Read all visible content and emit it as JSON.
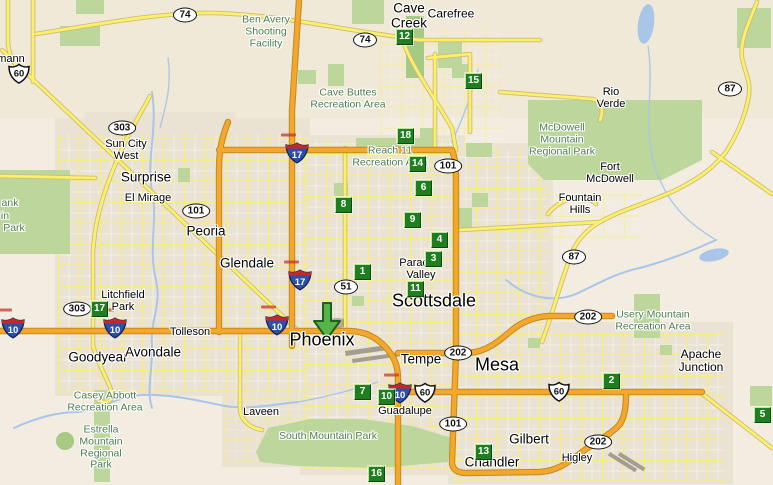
{
  "map": {
    "width": 773,
    "height": 485,
    "region": "Phoenix metropolitan area"
  },
  "palette": {
    "desert": "#F2EDE0",
    "urban": "#EAE3D4",
    "park": "#BCD69B",
    "park_dark": "#A6C983",
    "water": "#A9C5E8",
    "road_yellow": "#FBF169",
    "road_yellow_casing": "#CDBB7E",
    "road_orange": "#F5A72B",
    "road_orange_casing": "#BE8A25",
    "marker_green": "#1F7E1F",
    "marker_hi": "#BEE49E",
    "marker_lo": "#0B4A0B",
    "arrow_fill": "#57B44B",
    "arrow_stroke": "#1C611C",
    "park_label": "#4E7D50",
    "shield_blue": "#2B50A8",
    "shield_red": "#C62828"
  },
  "arrow": {
    "x": 327,
    "y": 320
  },
  "markers": [
    {
      "n": "1",
      "x": 362,
      "y": 271
    },
    {
      "n": "2",
      "x": 611,
      "y": 380
    },
    {
      "n": "3",
      "x": 433,
      "y": 258
    },
    {
      "n": "4",
      "x": 439,
      "y": 239
    },
    {
      "n": "5",
      "x": 762,
      "y": 414
    },
    {
      "n": "6",
      "x": 423,
      "y": 187
    },
    {
      "n": "7",
      "x": 362,
      "y": 391
    },
    {
      "n": "8",
      "x": 343,
      "y": 204
    },
    {
      "n": "9",
      "x": 412,
      "y": 219
    },
    {
      "n": "10",
      "x": 386,
      "y": 396
    },
    {
      "n": "11",
      "x": 415,
      "y": 288
    },
    {
      "n": "12",
      "x": 404,
      "y": 36
    },
    {
      "n": "13",
      "x": 483,
      "y": 451
    },
    {
      "n": "14",
      "x": 417,
      "y": 163
    },
    {
      "n": "15",
      "x": 473,
      "y": 80
    },
    {
      "n": "16",
      "x": 376,
      "y": 473
    },
    {
      "n": "17",
      "x": 99,
      "y": 308
    },
    {
      "n": "18",
      "x": 405,
      "y": 135
    }
  ],
  "shields": [
    {
      "type": "oval",
      "num": "74",
      "x": 185,
      "y": 15
    },
    {
      "type": "oval",
      "num": "74",
      "x": 365,
      "y": 40
    },
    {
      "type": "oval",
      "num": "303",
      "x": 122,
      "y": 128
    },
    {
      "type": "oval",
      "num": "303",
      "x": 77,
      "y": 309
    },
    {
      "type": "oval",
      "num": "101",
      "x": 196,
      "y": 211
    },
    {
      "type": "oval",
      "num": "101",
      "x": 448,
      "y": 166
    },
    {
      "type": "oval",
      "num": "101",
      "x": 453,
      "y": 424
    },
    {
      "type": "oval",
      "num": "51",
      "x": 346,
      "y": 287
    },
    {
      "type": "oval",
      "num": "202",
      "x": 458,
      "y": 353
    },
    {
      "type": "oval",
      "num": "202",
      "x": 588,
      "y": 317
    },
    {
      "type": "oval",
      "num": "202",
      "x": 598,
      "y": 442
    },
    {
      "type": "oval",
      "num": "87",
      "x": 730,
      "y": 89
    },
    {
      "type": "oval",
      "num": "87",
      "x": 574,
      "y": 257
    },
    {
      "type": "us",
      "num": "60",
      "x": 20,
      "y": 74
    },
    {
      "type": "us",
      "num": "60",
      "x": 426,
      "y": 393
    },
    {
      "type": "us",
      "num": "60",
      "x": 560,
      "y": 392
    },
    {
      "type": "interstate",
      "num": "10",
      "x": 13,
      "y": 328
    },
    {
      "type": "interstate",
      "num": "10",
      "x": 115,
      "y": 328
    },
    {
      "type": "interstate",
      "num": "10",
      "x": 277,
      "y": 325
    },
    {
      "type": "interstate",
      "num": "10",
      "x": 400,
      "y": 393
    },
    {
      "type": "interstate",
      "num": "17",
      "x": 297,
      "y": 153
    },
    {
      "type": "interstate",
      "num": "17",
      "x": 300,
      "y": 280
    }
  ],
  "city_labels": [
    {
      "text": "mann",
      "x": 11,
      "y": 60,
      "size": "sm"
    },
    {
      "text": "Sun City\nWest",
      "x": 126,
      "y": 151,
      "size": "sm"
    },
    {
      "text": "Surprise",
      "x": 146,
      "y": 178,
      "size": "lg"
    },
    {
      "text": "El Mirage",
      "x": 148,
      "y": 199,
      "size": "sm"
    },
    {
      "text": "Peoria",
      "x": 206,
      "y": 232,
      "size": "lg"
    },
    {
      "text": "Glendale",
      "x": 247,
      "y": 264,
      "size": "lg"
    },
    {
      "text": "Litchfield\nPark",
      "x": 123,
      "y": 302,
      "size": "sm"
    },
    {
      "text": "Tolleson",
      "x": 190,
      "y": 333,
      "size": "sm"
    },
    {
      "text": "Goodyear",
      "x": 98,
      "y": 358,
      "size": "lg"
    },
    {
      "text": "Avondale",
      "x": 153,
      "y": 353,
      "size": "lg"
    },
    {
      "text": "Laveen",
      "x": 261,
      "y": 413,
      "size": "sm"
    },
    {
      "text": "Phoenix",
      "x": 322,
      "y": 340,
      "size": "xl"
    },
    {
      "text": "Guadalupe",
      "x": 405,
      "y": 412,
      "size": "sm"
    },
    {
      "text": "Tempe",
      "x": 421,
      "y": 360,
      "size": "lg"
    },
    {
      "text": "Mesa",
      "x": 497,
      "y": 365,
      "size": "xl"
    },
    {
      "text": "Scottsdale",
      "x": 434,
      "y": 301,
      "size": "xl"
    },
    {
      "text": "Paradise\nValley",
      "x": 421,
      "y": 270,
      "size": "sm"
    },
    {
      "text": "Cave\nCreek",
      "x": 409,
      "y": 16,
      "size": "lg"
    },
    {
      "text": "Carefree",
      "x": 451,
      "y": 14,
      "size": "md"
    },
    {
      "text": "Chandler",
      "x": 492,
      "y": 463,
      "size": "lg"
    },
    {
      "text": "Gilbert",
      "x": 529,
      "y": 440,
      "size": "lg"
    },
    {
      "text": "Higley",
      "x": 577,
      "y": 459,
      "size": "sm"
    },
    {
      "text": "Apache\nJunction",
      "x": 701,
      "y": 361,
      "size": "md"
    },
    {
      "text": "Fountain\nHills",
      "x": 580,
      "y": 205,
      "size": "sm"
    },
    {
      "text": "Fort\nMcDowell",
      "x": 610,
      "y": 174,
      "size": "sm"
    },
    {
      "text": "Rio\nVerde",
      "x": 611,
      "y": 99,
      "size": "sm"
    }
  ],
  "park_labels": [
    {
      "text": "Ben Avery\nShooting\nFacility",
      "x": 266,
      "y": 32
    },
    {
      "text": "Cave Buttes\nRecreation Area",
      "x": 348,
      "y": 99
    },
    {
      "text": "McDowell\nMountain\nRegional Park",
      "x": 562,
      "y": 140
    },
    {
      "text": "Reach 11\nRecreation Area",
      "x": 390,
      "y": 157
    },
    {
      "text": "Usery Mountain\nRecreation Area",
      "x": 653,
      "y": 321
    },
    {
      "text": "Casey Abbott\nRecreation Area",
      "x": 105,
      "y": 402
    },
    {
      "text": "Estrella\nMountain\nRegional\nPark",
      "x": 101,
      "y": 448
    },
    {
      "text": "South Mountain Park",
      "x": 328,
      "y": 437
    },
    {
      "text": "ank",
      "x": 10,
      "y": 204
    },
    {
      "text": "in",
      "x": 5,
      "y": 217
    },
    {
      "text": "Park",
      "x": 14,
      "y": 229
    }
  ]
}
